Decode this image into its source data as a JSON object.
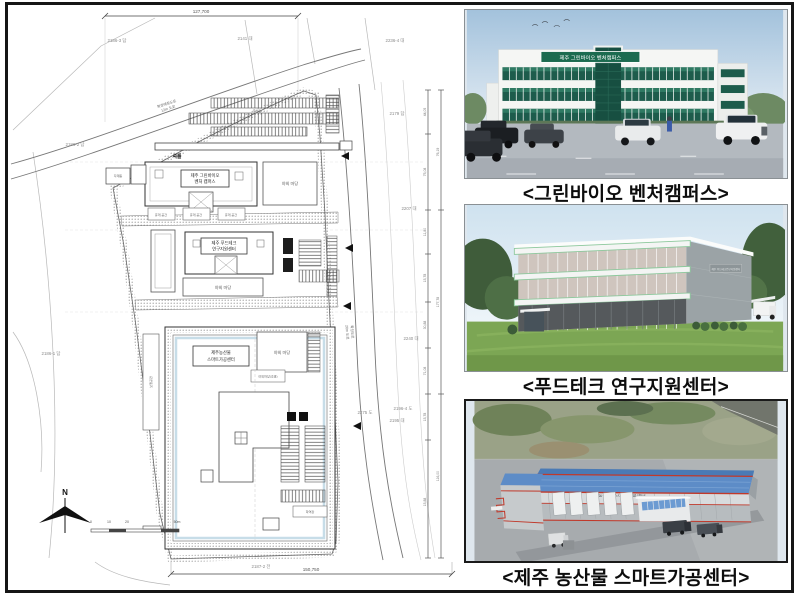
{
  "photos": {
    "green_bio": {
      "caption": "<그린바이오 벤처캠퍼스>",
      "sign": "제주 그린바이오 벤처캠퍼스"
    },
    "food_tech": {
      "caption": "<푸드테크 연구지원센터>",
      "sign": "제주 푸드테크연구지원센터"
    },
    "smart": {
      "caption": "<제주 농산물 스마트가공센터>",
      "sign": "제주 농산물 스마트가공센터"
    }
  },
  "plan": {
    "dim_top": "127,700",
    "dim_bottom": "150,750",
    "dim_right": [
      "44,05",
      "76,19",
      "75,08",
      "11,80",
      "15,78",
      "30,88",
      "71,08",
      "15,78",
      "177,78",
      "116,00",
      "15,88"
    ],
    "parcels": {
      "p1": "2186-3 답",
      "p2": "2141 대",
      "p3": "2236-4 대",
      "p4": "2186-2 답",
      "p5": "2179 답",
      "p6": "2207 대",
      "p7": "2186-1 답",
      "p8": "2240 대",
      "p9": "2275 도",
      "p10": "2196-4 도",
      "p11": "2195 대",
      "p12": "2187-2 전"
    },
    "roads": {
      "r1a": "확장예정도로",
      "r1b": "12m 도로",
      "r2a": "확장도로",
      "r2b": "20m 도로"
    },
    "buildings": {
      "b1a": "제주 그린바이오",
      "b1b": "벤처 캠퍼스",
      "b2a": "제주 푸드테크",
      "b2b": "연구지원센터",
      "b3a": "제주농산물",
      "b3b": "스마트가공센터"
    },
    "labels": {
      "yard": "야외 마당",
      "parking": "주차장",
      "rest": "휴게 공간",
      "storage": "자재동",
      "walk": "보행공간",
      "landscape": "야외마당(조경)",
      "dock": "하역장",
      "shuttle": "셔틀"
    },
    "compass": "N",
    "scale": {
      "s0": "0",
      "s1": "10",
      "s2": "20",
      "s3": "50m"
    }
  }
}
